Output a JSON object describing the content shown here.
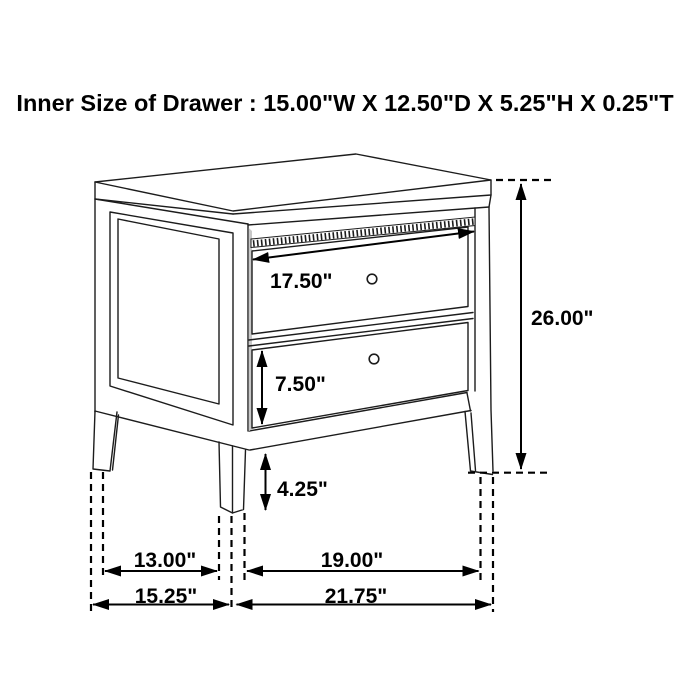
{
  "title": "Inner Size of Drawer : 15.00\"W X 12.50\"D X 5.25\"H X 0.25\"T",
  "figure": {
    "kind": "furniture-dimension-line-drawing",
    "item": "two-drawer nightstand, three-quarter perspective view"
  },
  "inner_drawer_size": {
    "width": "15.00\"W",
    "depth": "12.50\"D",
    "height": "5.25\"H",
    "thickness": "0.25\"T"
  },
  "dims": {
    "drawer_width": "17.50\"",
    "overall_height": "26.00\"",
    "bottom_drawer_height": "7.50\"",
    "leg_height": "4.25\"",
    "side_leg_gap": "13.00\"",
    "front_leg_gap": "19.00\"",
    "overall_depth": "15.25\"",
    "overall_width": "21.75\""
  },
  "colors": {
    "line": "#1c1c1c",
    "background": "#ffffff",
    "reveal_gray": "#c8c8c8"
  }
}
